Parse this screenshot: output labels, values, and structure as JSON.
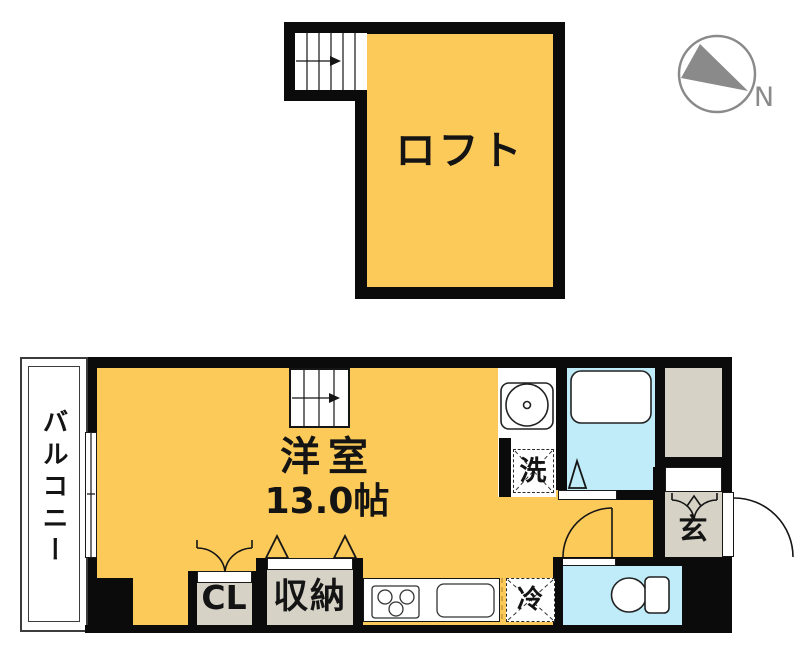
{
  "labels": {
    "loft": "ロフト",
    "room": "洋室",
    "room_size": "13.0帖",
    "balcony": "バルコニー",
    "closet": "CL",
    "storage": "収納",
    "entrance": "玄",
    "washer": "洗",
    "fridge": "冷",
    "north": "N"
  },
  "colors": {
    "room_fill": "#FCCA59",
    "bath_fill": "#BFECF8",
    "service_fill": "#D6D2C6",
    "wall": "#0B0B0B",
    "compass": "#8A8A8A"
  },
  "fixtures": [
    "compass-north-icon",
    "loft-stairs-icon",
    "main-stairs-icon",
    "balcony-window-icon",
    "closet-swing-doors-icon",
    "storage-folding-doors-icon",
    "bathroom-folding-door-icon",
    "toilet-door-swing-icon",
    "entrance-door-swing-icon",
    "shoe-cabinet-doors-icon",
    "washbasin-icon",
    "bathtub-icon",
    "stove-icon",
    "kitchen-sink-icon",
    "toilet-icon",
    "washing-machine-space-icon",
    "refrigerator-space-icon"
  ]
}
